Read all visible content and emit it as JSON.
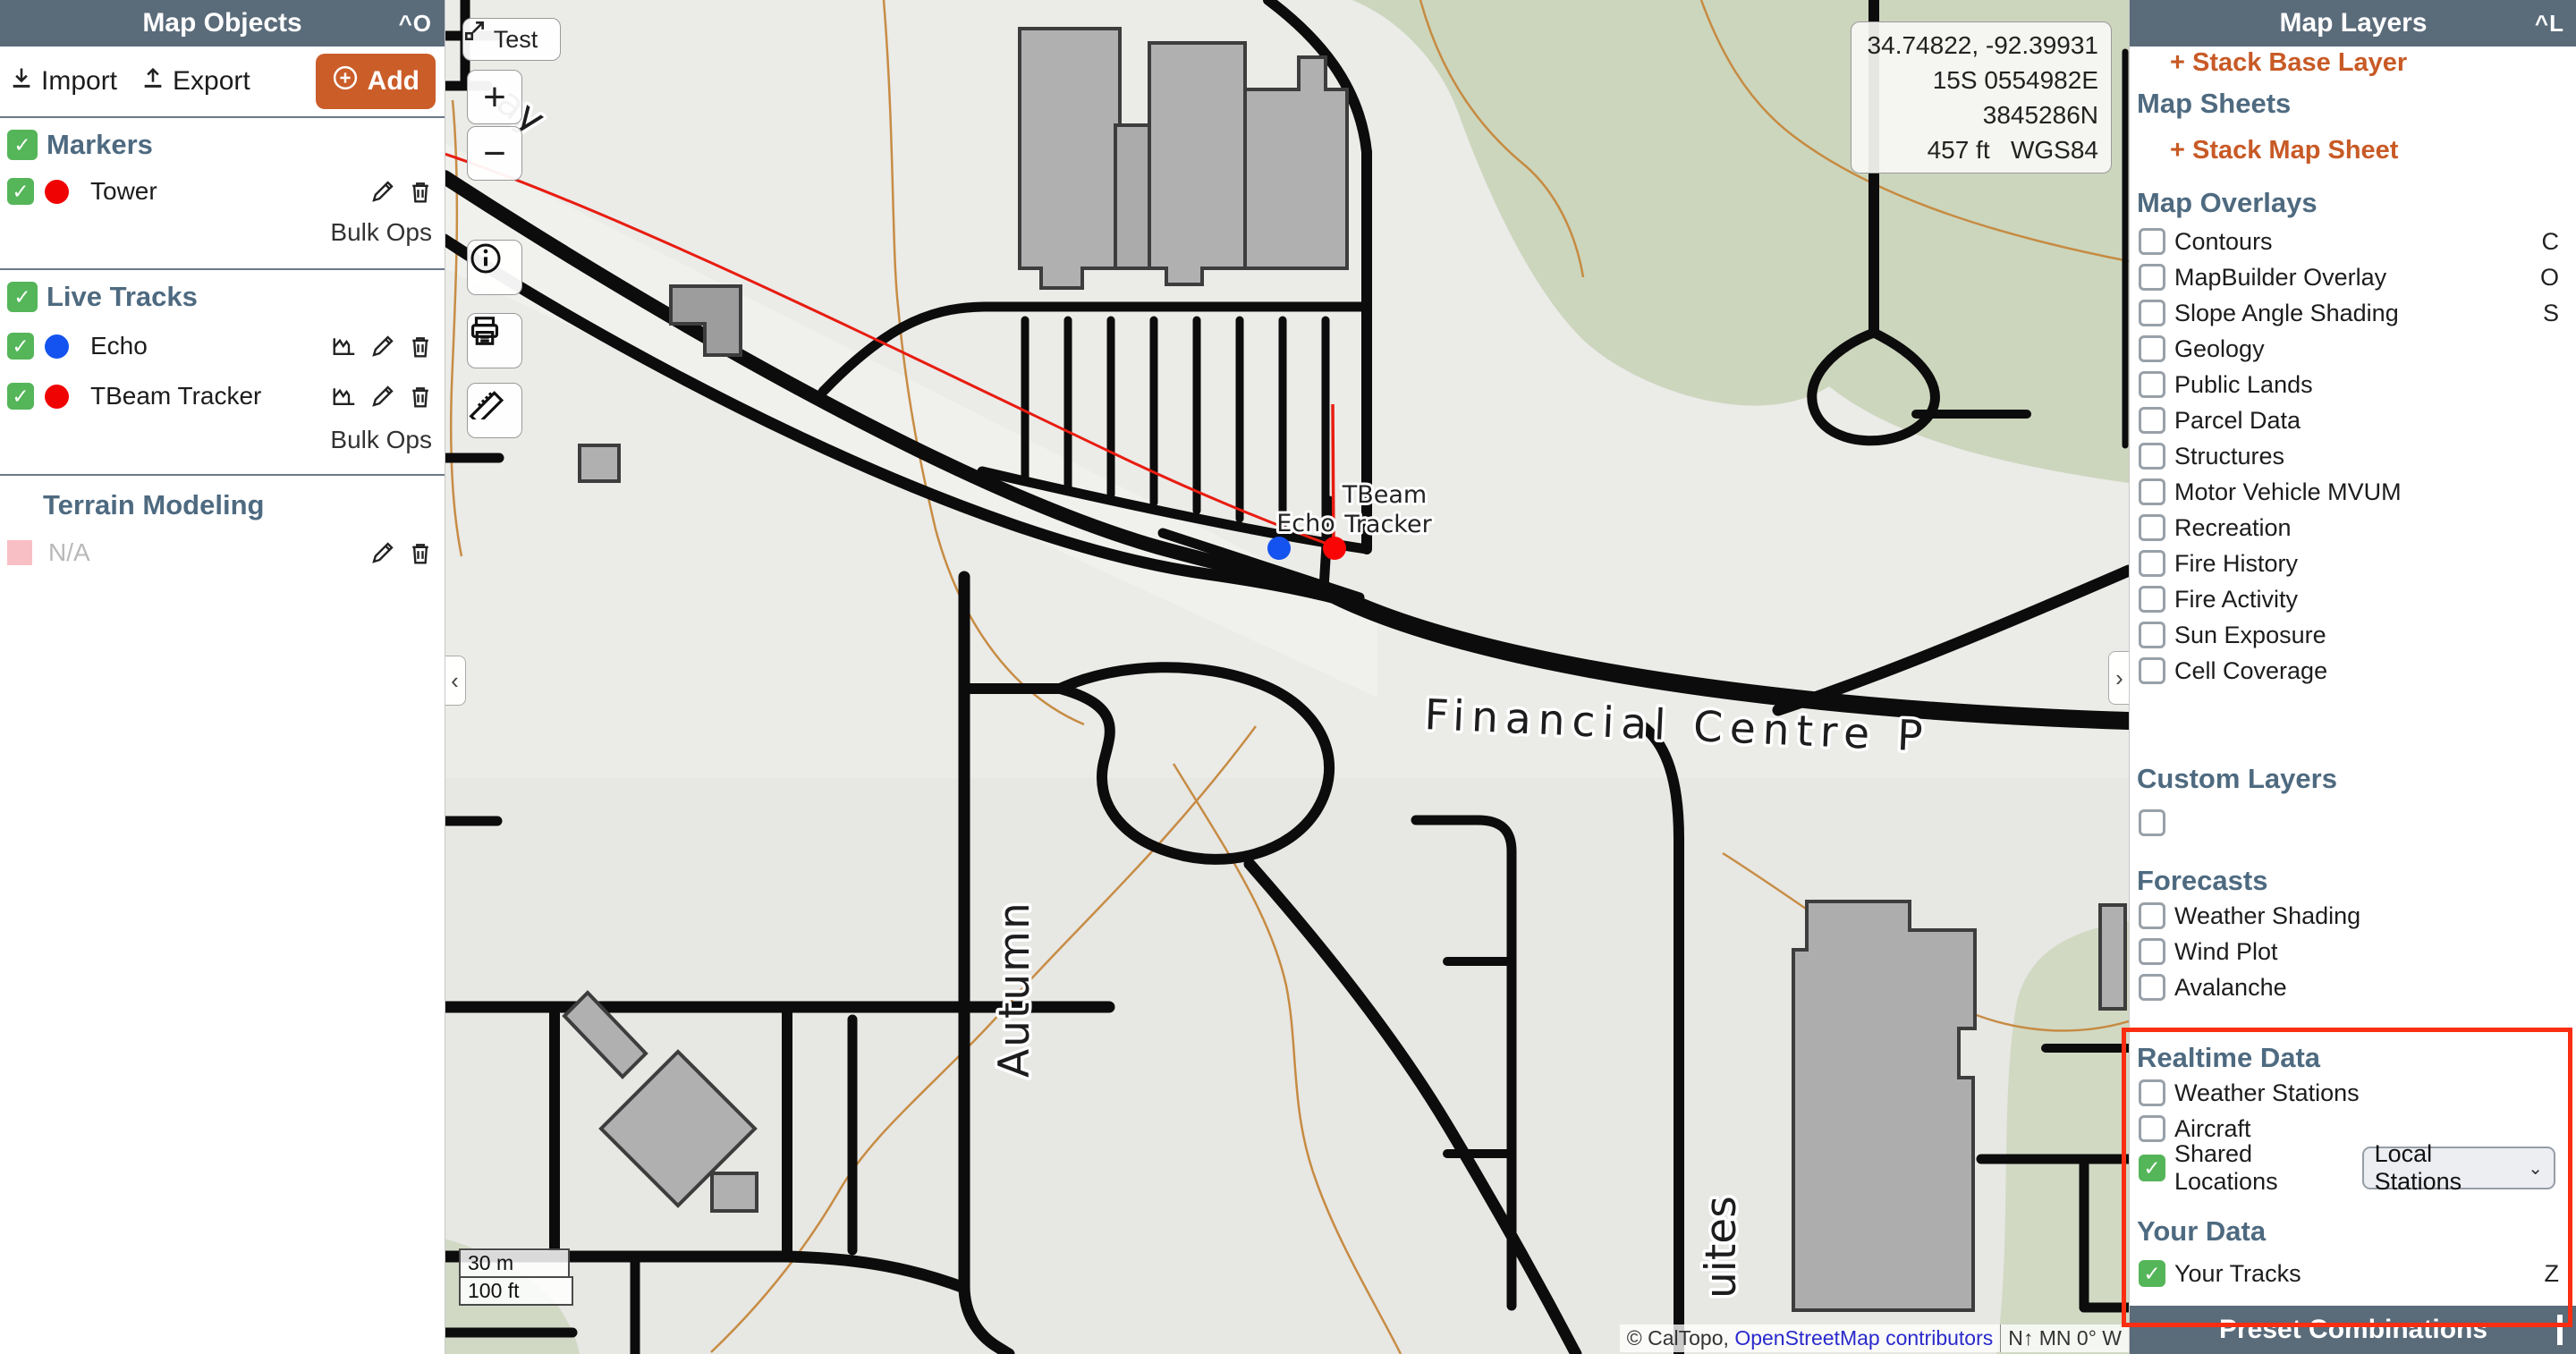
{
  "left_panel": {
    "title": "Map Objects",
    "shortcut": "^O",
    "toolbar": {
      "import_label": "Import",
      "export_label": "Export",
      "add_label": "Add"
    },
    "markers": {
      "heading": "Markers",
      "items": [
        {
          "label": "Tower",
          "color": "#f00303"
        }
      ],
      "bulk_ops": "Bulk Ops"
    },
    "live_tracks": {
      "heading": "Live Tracks",
      "items": [
        {
          "label": "Echo",
          "color": "#1453ef"
        },
        {
          "label": "TBeam Tracker",
          "color": "#f00303"
        }
      ],
      "bulk_ops": "Bulk Ops"
    },
    "terrain": {
      "heading": "Terrain Modeling",
      "item_label": "N/A",
      "item_color": "#f8bfc4"
    }
  },
  "right_panel": {
    "title": "Map Layers",
    "shortcut": "^L",
    "stack_base_layer": "+ Stack Base Layer",
    "map_sheets": {
      "heading": "Map Sheets",
      "stack_map_sheet": "+ Stack Map Sheet"
    },
    "map_overlays": {
      "heading": "Map Overlays",
      "items": [
        {
          "label": "Contours",
          "key": "C",
          "checked": false
        },
        {
          "label": "MapBuilder Overlay",
          "key": "O",
          "checked": false
        },
        {
          "label": "Slope Angle Shading",
          "key": "S",
          "checked": false
        },
        {
          "label": "Geology",
          "key": "",
          "checked": false
        },
        {
          "label": "Public Lands",
          "key": "",
          "checked": false
        },
        {
          "label": "Parcel Data",
          "key": "",
          "checked": false
        },
        {
          "label": "Structures",
          "key": "",
          "checked": false
        },
        {
          "label": "Motor Vehicle MVUM",
          "key": "",
          "checked": false
        },
        {
          "label": "Recreation",
          "key": "",
          "checked": false
        },
        {
          "label": "Fire History",
          "key": "",
          "checked": false
        },
        {
          "label": "Fire Activity",
          "key": "",
          "checked": false
        },
        {
          "label": "Sun Exposure",
          "key": "",
          "checked": false
        },
        {
          "label": "Cell Coverage",
          "key": "",
          "checked": false
        }
      ]
    },
    "custom_layers": {
      "heading": "Custom Layers"
    },
    "forecasts": {
      "heading": "Forecasts",
      "items": [
        {
          "label": "Weather Shading",
          "key": "",
          "checked": false
        },
        {
          "label": "Wind Plot",
          "key": "",
          "checked": false
        },
        {
          "label": "Avalanche",
          "key": "",
          "checked": false
        }
      ]
    },
    "realtime": {
      "heading": "Realtime Data",
      "weather_stations": "Weather Stations",
      "aircraft": "Aircraft",
      "shared_locations": "Shared Locations",
      "shared_locations_value": "Local Stations"
    },
    "your_data": {
      "heading": "Your Data",
      "your_tracks": "Your Tracks",
      "key": "Z"
    },
    "footer": "Preset Combinations"
  },
  "map": {
    "test_button": "Test",
    "zoom_in": "+",
    "zoom_out": "−",
    "coordinates": {
      "latlon": "34.74822, -92.39931",
      "utm": "15S 0554982E 3845286N",
      "elevation": "457 ft",
      "datum": "WGS84"
    },
    "scale": {
      "metric": "30 m",
      "imperial": "100 ft"
    },
    "attribution": {
      "caltopo": "© CalTopo,",
      "osm_link": "OpenStreetMap contributors",
      "compass": "N↑ MN 0° W"
    },
    "tracker_labels": {
      "tbeam": "TBeam",
      "echo": "Echo",
      "tracker": "Tracker"
    },
    "street_labels": {
      "financial": "Financial Centre P",
      "autumn": "Autumn",
      "suites": "uites",
      "partial": "ay"
    }
  },
  "colors": {
    "panel_header_bg": "#5a6b7a",
    "accent_orange": "#cb5d29",
    "check_green": "#55b559",
    "marker_red": "#f00303",
    "track_blue": "#1453ef",
    "track_line_red": "#e81c10",
    "annotation_red": "#fb2e12",
    "contour_orange": "#c5873b",
    "park_green": "#ccd6bd"
  }
}
